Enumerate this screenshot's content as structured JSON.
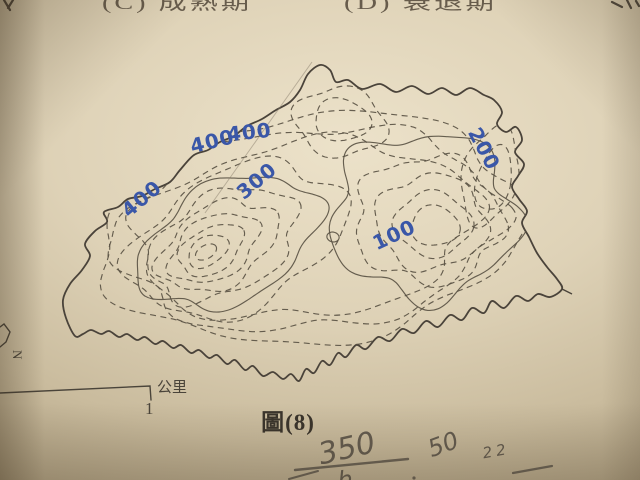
{
  "page": {
    "top_options": [
      {
        "label": "(C) 成熟期"
      },
      {
        "label": "(D) 衰退期"
      }
    ],
    "caption": "圖(8)",
    "scale": {
      "unit_label": "公里",
      "value_label": "1"
    },
    "north_label": "N"
  },
  "map": {
    "type": "topographic-contour-map",
    "ink_color": "#4a433a",
    "label_color": "#3a57a8",
    "contour_interval_labels": [
      "400",
      "400",
      "400",
      "300",
      "200",
      "100"
    ],
    "coastline": [
      [
        75,
        336
      ],
      [
        66,
        318
      ],
      [
        63,
        300
      ],
      [
        70,
        284
      ],
      [
        82,
        270
      ],
      [
        90,
        256
      ],
      [
        85,
        244
      ],
      [
        95,
        231
      ],
      [
        107,
        222
      ],
      [
        104,
        212
      ],
      [
        118,
        207
      ],
      [
        128,
        199
      ],
      [
        142,
        196
      ],
      [
        155,
        189
      ],
      [
        170,
        182
      ],
      [
        180,
        170
      ],
      [
        194,
        155
      ],
      [
        208,
        150
      ],
      [
        220,
        142
      ],
      [
        234,
        136
      ],
      [
        247,
        126
      ],
      [
        262,
        119
      ],
      [
        276,
        110
      ],
      [
        290,
        102
      ],
      [
        300,
        90
      ],
      [
        308,
        74
      ],
      [
        320,
        65
      ],
      [
        330,
        70
      ],
      [
        336,
        82
      ],
      [
        348,
        80
      ],
      [
        362,
        89
      ],
      [
        380,
        84
      ],
      [
        396,
        92
      ],
      [
        412,
        86
      ],
      [
        428,
        94
      ],
      [
        442,
        88
      ],
      [
        456,
        95
      ],
      [
        470,
        88
      ],
      [
        484,
        95
      ],
      [
        494,
        100
      ],
      [
        502,
        112
      ],
      [
        497,
        124
      ],
      [
        506,
        132
      ],
      [
        516,
        127
      ],
      [
        522,
        140
      ],
      [
        515,
        152
      ],
      [
        524,
        164
      ],
      [
        518,
        176
      ],
      [
        512,
        187
      ],
      [
        519,
        199
      ],
      [
        527,
        211
      ],
      [
        522,
        223
      ],
      [
        529,
        237
      ],
      [
        537,
        253
      ],
      [
        547,
        267
      ],
      [
        557,
        279
      ],
      [
        562,
        289
      ],
      [
        550,
        297
      ],
      [
        538,
        294
      ],
      [
        528,
        301
      ],
      [
        516,
        296
      ],
      [
        504,
        308
      ],
      [
        492,
        301
      ],
      [
        484,
        313
      ],
      [
        472,
        308
      ],
      [
        462,
        320
      ],
      [
        450,
        315
      ],
      [
        438,
        327
      ],
      [
        426,
        321
      ],
      [
        414,
        333
      ],
      [
        402,
        329
      ],
      [
        390,
        341
      ],
      [
        378,
        337
      ],
      [
        366,
        349
      ],
      [
        356,
        345
      ],
      [
        346,
        357
      ],
      [
        338,
        353
      ],
      [
        330,
        365
      ],
      [
        322,
        361
      ],
      [
        314,
        373
      ],
      [
        306,
        369
      ],
      [
        299,
        381
      ],
      [
        291,
        374
      ],
      [
        283,
        379
      ],
      [
        273,
        372
      ],
      [
        263,
        376
      ],
      [
        253,
        366
      ],
      [
        245,
        370
      ],
      [
        235,
        360
      ],
      [
        227,
        364
      ],
      [
        217,
        355
      ],
      [
        209,
        358
      ],
      [
        199,
        350
      ],
      [
        191,
        353
      ],
      [
        181,
        345
      ],
      [
        173,
        348
      ],
      [
        163,
        341
      ],
      [
        155,
        344
      ],
      [
        145,
        337
      ],
      [
        137,
        340
      ],
      [
        127,
        334
      ],
      [
        119,
        337
      ],
      [
        109,
        331
      ],
      [
        101,
        334
      ],
      [
        91,
        330
      ],
      [
        83,
        334
      ]
    ],
    "contours": [
      {
        "style": "dashed",
        "cx": 310,
        "cy": 228,
        "rx": 212,
        "ry": 114,
        "rot": -6,
        "h": [
          [
            5,
            0.05,
            0.5
          ],
          [
            9,
            0.03,
            2.1
          ]
        ]
      },
      {
        "style": "dashed",
        "cx": 308,
        "cy": 229,
        "rx": 192,
        "ry": 100,
        "rot": -6,
        "h": [
          [
            6,
            0.06,
            1.2
          ],
          [
            11,
            0.03,
            0.4
          ]
        ]
      },
      {
        "style": "dashed",
        "cx": 305,
        "cy": 230,
        "rx": 172,
        "ry": 87,
        "rot": -7,
        "h": [
          [
            5,
            0.07,
            2.4
          ],
          [
            9,
            0.04,
            1.0
          ]
        ]
      },
      {
        "style": "dashed",
        "cx": 237,
        "cy": 240,
        "rx": 112,
        "ry": 68,
        "rot": -24,
        "h": [
          [
            4,
            0.09,
            0.3
          ],
          [
            7,
            0.05,
            1.8
          ]
        ]
      },
      {
        "style": "solid",
        "cx": 229,
        "cy": 242,
        "rx": 95,
        "ry": 58,
        "rot": -26,
        "h": [
          [
            4,
            0.08,
            1.0
          ],
          [
            7,
            0.05,
            0.2
          ]
        ]
      },
      {
        "style": "dashed",
        "cx": 223,
        "cy": 244,
        "rx": 79,
        "ry": 49,
        "rot": -28,
        "h": [
          [
            5,
            0.08,
            2.0
          ],
          [
            8,
            0.04,
            0.9
          ]
        ]
      },
      {
        "style": "dashed",
        "cx": 218,
        "cy": 246,
        "rx": 63,
        "ry": 39,
        "rot": -29,
        "h": [
          [
            4,
            0.09,
            0.7
          ],
          [
            7,
            0.05,
            2.5
          ]
        ]
      },
      {
        "style": "dashed",
        "cx": 214,
        "cy": 248,
        "rx": 48,
        "ry": 30,
        "rot": -30,
        "h": [
          [
            4,
            0.08,
            1.5
          ],
          [
            6,
            0.04,
            0.5
          ]
        ]
      },
      {
        "style": "dashed",
        "cx": 211,
        "cy": 250,
        "rx": 35,
        "ry": 22,
        "rot": -31,
        "h": [
          [
            3,
            0.07,
            2.2
          ],
          [
            5,
            0.04,
            1.2
          ]
        ]
      },
      {
        "style": "dashed",
        "cx": 208,
        "cy": 251,
        "rx": 22,
        "ry": 14,
        "rot": -32,
        "h": [
          [
            3,
            0.06,
            0.4
          ]
        ]
      },
      {
        "style": "dashed",
        "cx": 206,
        "cy": 252,
        "rx": 11,
        "ry": 7,
        "rot": -32,
        "h": [
          [
            2,
            0.05,
            1.0
          ]
        ]
      },
      {
        "style": "dashed",
        "cx": 340,
        "cy": 122,
        "rx": 46,
        "ry": 34,
        "rot": 8,
        "h": [
          [
            4,
            0.1,
            0.8
          ]
        ]
      },
      {
        "style": "dashed",
        "cx": 342,
        "cy": 120,
        "rx": 28,
        "ry": 21,
        "rot": 8,
        "h": [
          [
            3,
            0.08,
            1.6
          ]
        ]
      },
      {
        "style": "solid",
        "cx": 424,
        "cy": 216,
        "rx": 92,
        "ry": 82,
        "rot": 4,
        "h": [
          [
            5,
            0.11,
            0.9
          ],
          [
            8,
            0.05,
            2.2
          ]
        ]
      },
      {
        "style": "dashed",
        "cx": 428,
        "cy": 220,
        "rx": 73,
        "ry": 63,
        "rot": 4,
        "h": [
          [
            5,
            0.09,
            1.7
          ],
          [
            9,
            0.04,
            0.3
          ]
        ]
      },
      {
        "style": "dashed",
        "cx": 431,
        "cy": 222,
        "rx": 55,
        "ry": 47,
        "rot": 4,
        "h": [
          [
            4,
            0.08,
            0.5
          ],
          [
            7,
            0.04,
            1.3
          ]
        ]
      },
      {
        "style": "dashed",
        "cx": 433,
        "cy": 224,
        "rx": 38,
        "ry": 32,
        "rot": 4,
        "h": [
          [
            4,
            0.08,
            1.9
          ]
        ]
      },
      {
        "style": "dashed",
        "cx": 435,
        "cy": 226,
        "rx": 24,
        "ry": 20,
        "rot": 4,
        "h": [
          [
            3,
            0.07,
            0.9
          ]
        ]
      },
      {
        "style": "dashed",
        "cx": 490,
        "cy": 176,
        "rx": 27,
        "ry": 50,
        "rot": 14,
        "h": [
          [
            4,
            0.08,
            1.2
          ]
        ]
      },
      {
        "style": "dashed",
        "cx": 494,
        "cy": 179,
        "rx": 17,
        "ry": 33,
        "rot": 14,
        "h": [
          [
            3,
            0.07,
            0.2
          ]
        ]
      },
      {
        "style": "solid",
        "cx": 333,
        "cy": 237,
        "rx": 6,
        "ry": 5,
        "rot": 0,
        "h": [
          [
            2,
            0.05,
            0.3
          ]
        ]
      }
    ]
  },
  "annotations": {
    "pencil_color": "#6b6356",
    "fraction_numerator": "350",
    "fraction_denominator": "h",
    "note_fifty": "50",
    "note_twentytwo": "22"
  }
}
